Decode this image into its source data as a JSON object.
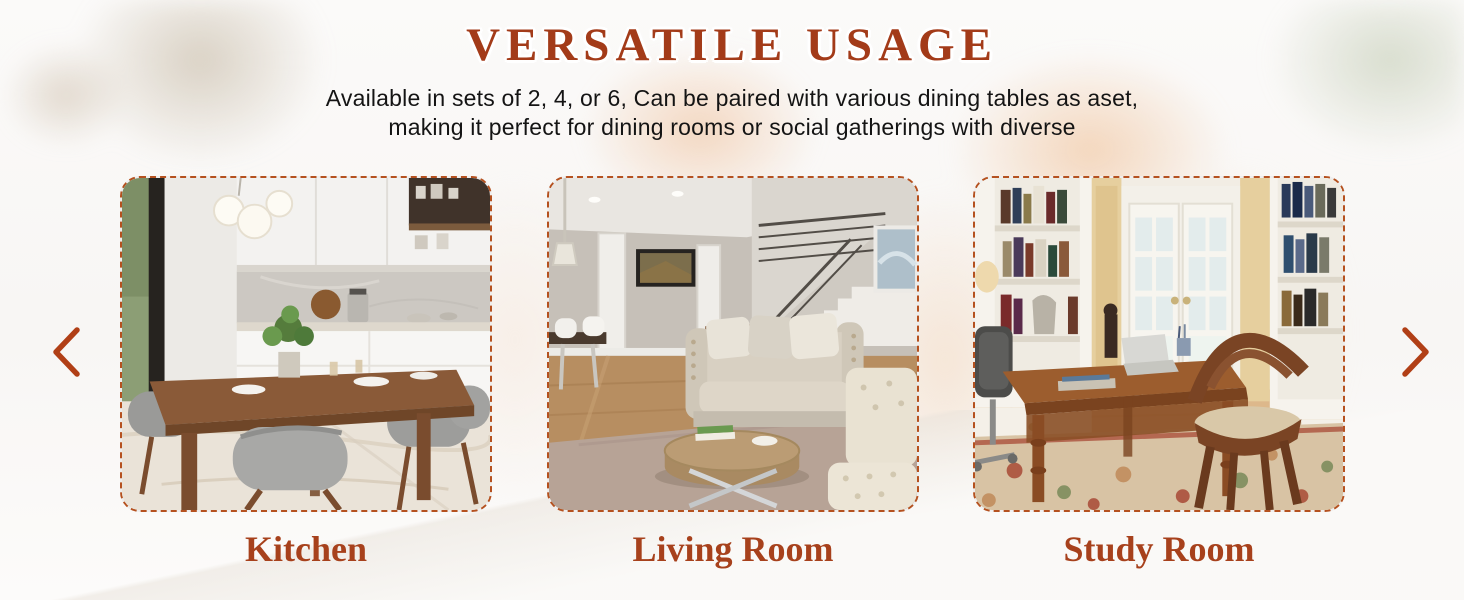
{
  "header": {
    "title": "VERSATILE USAGE",
    "subtitle_line1": "Available in sets of 2, 4, or 6, Can be paired with various dining tables as aset,",
    "subtitle_line2": "making it perfect for dining rooms or social gatherings with diverse"
  },
  "carousel": {
    "prev_icon": "chevron-left",
    "next_icon": "chevron-right",
    "slides": [
      {
        "caption": "Kitchen",
        "photo": "kitchen-dining-scene"
      },
      {
        "caption": "Living Room",
        "photo": "living-room-scene"
      },
      {
        "caption": "Study Room",
        "photo": "study-room-scene"
      }
    ]
  },
  "colors": {
    "title_text": "#a33b19",
    "caption_text": "#a7411c",
    "card_dashed_border": "#b5511f",
    "arrow": "#b13f16",
    "subtitle_text": "#141414"
  }
}
